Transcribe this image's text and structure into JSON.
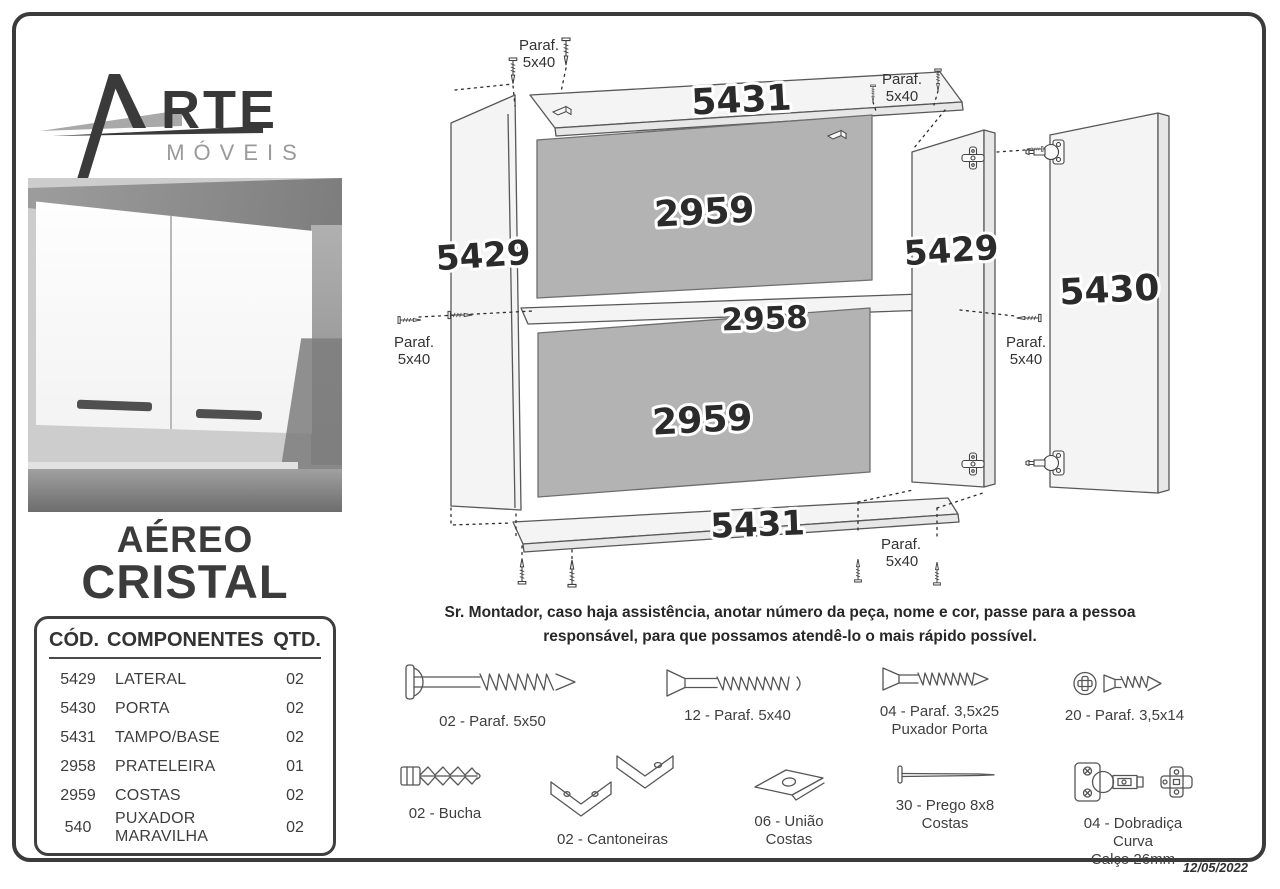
{
  "page": {
    "date": "12/05/2022"
  },
  "brand": {
    "name_rest": "RTE",
    "subtitle": "MÓVEIS"
  },
  "product": {
    "line1": "AÉREO",
    "line2": "CRISTAL"
  },
  "components": {
    "headers": {
      "code": "CÓD.",
      "name": "COMPONENTES",
      "qty": "QTD."
    },
    "rows": [
      {
        "code": "5429",
        "name": "LATERAL",
        "qty": "02"
      },
      {
        "code": "5430",
        "name": "PORTA",
        "qty": "02"
      },
      {
        "code": "5431",
        "name": "TAMPO/BASE",
        "qty": "02"
      },
      {
        "code": "2958",
        "name": "PRATELEIRA",
        "qty": "01"
      },
      {
        "code": "2959",
        "name": "COSTAS",
        "qty": "02"
      },
      {
        "code": "540",
        "name": "PUXADOR MARAVILHA",
        "qty": "02"
      }
    ]
  },
  "diagram": {
    "panel_top": "5431",
    "side_left": "5429",
    "back_upper": "2959",
    "shelf": "2958",
    "back_lower": "2959",
    "panel_bottom": "5431",
    "side_right": "5429",
    "door": "5430",
    "paraf_l1": "Paraf.",
    "paraf_l2": "5x40"
  },
  "note": {
    "line1": "Sr. Montador, caso haja assistência, anotar número da peça, nome e cor, passe para a pessoa",
    "line2": "responsável, para que possamos atendê-lo o mais rápido possível."
  },
  "hardware": {
    "row1": [
      {
        "label": "02 - Paraf. 5x50"
      },
      {
        "label": "12 - Paraf. 5x40"
      },
      {
        "label": "04 - Paraf. 3,5x25",
        "label2": "Puxador Porta"
      },
      {
        "label": "20 - Paraf. 3,5x14"
      }
    ],
    "row2": [
      {
        "label": "02 - Bucha"
      },
      {
        "label": "02 - Cantoneiras"
      },
      {
        "label": "06 - União Costas"
      },
      {
        "label": "30 - Prego 8x8",
        "label2": "Costas"
      },
      {
        "label": "04 - Dobradiça Curva",
        "label2": "Calço 26mm"
      }
    ]
  }
}
